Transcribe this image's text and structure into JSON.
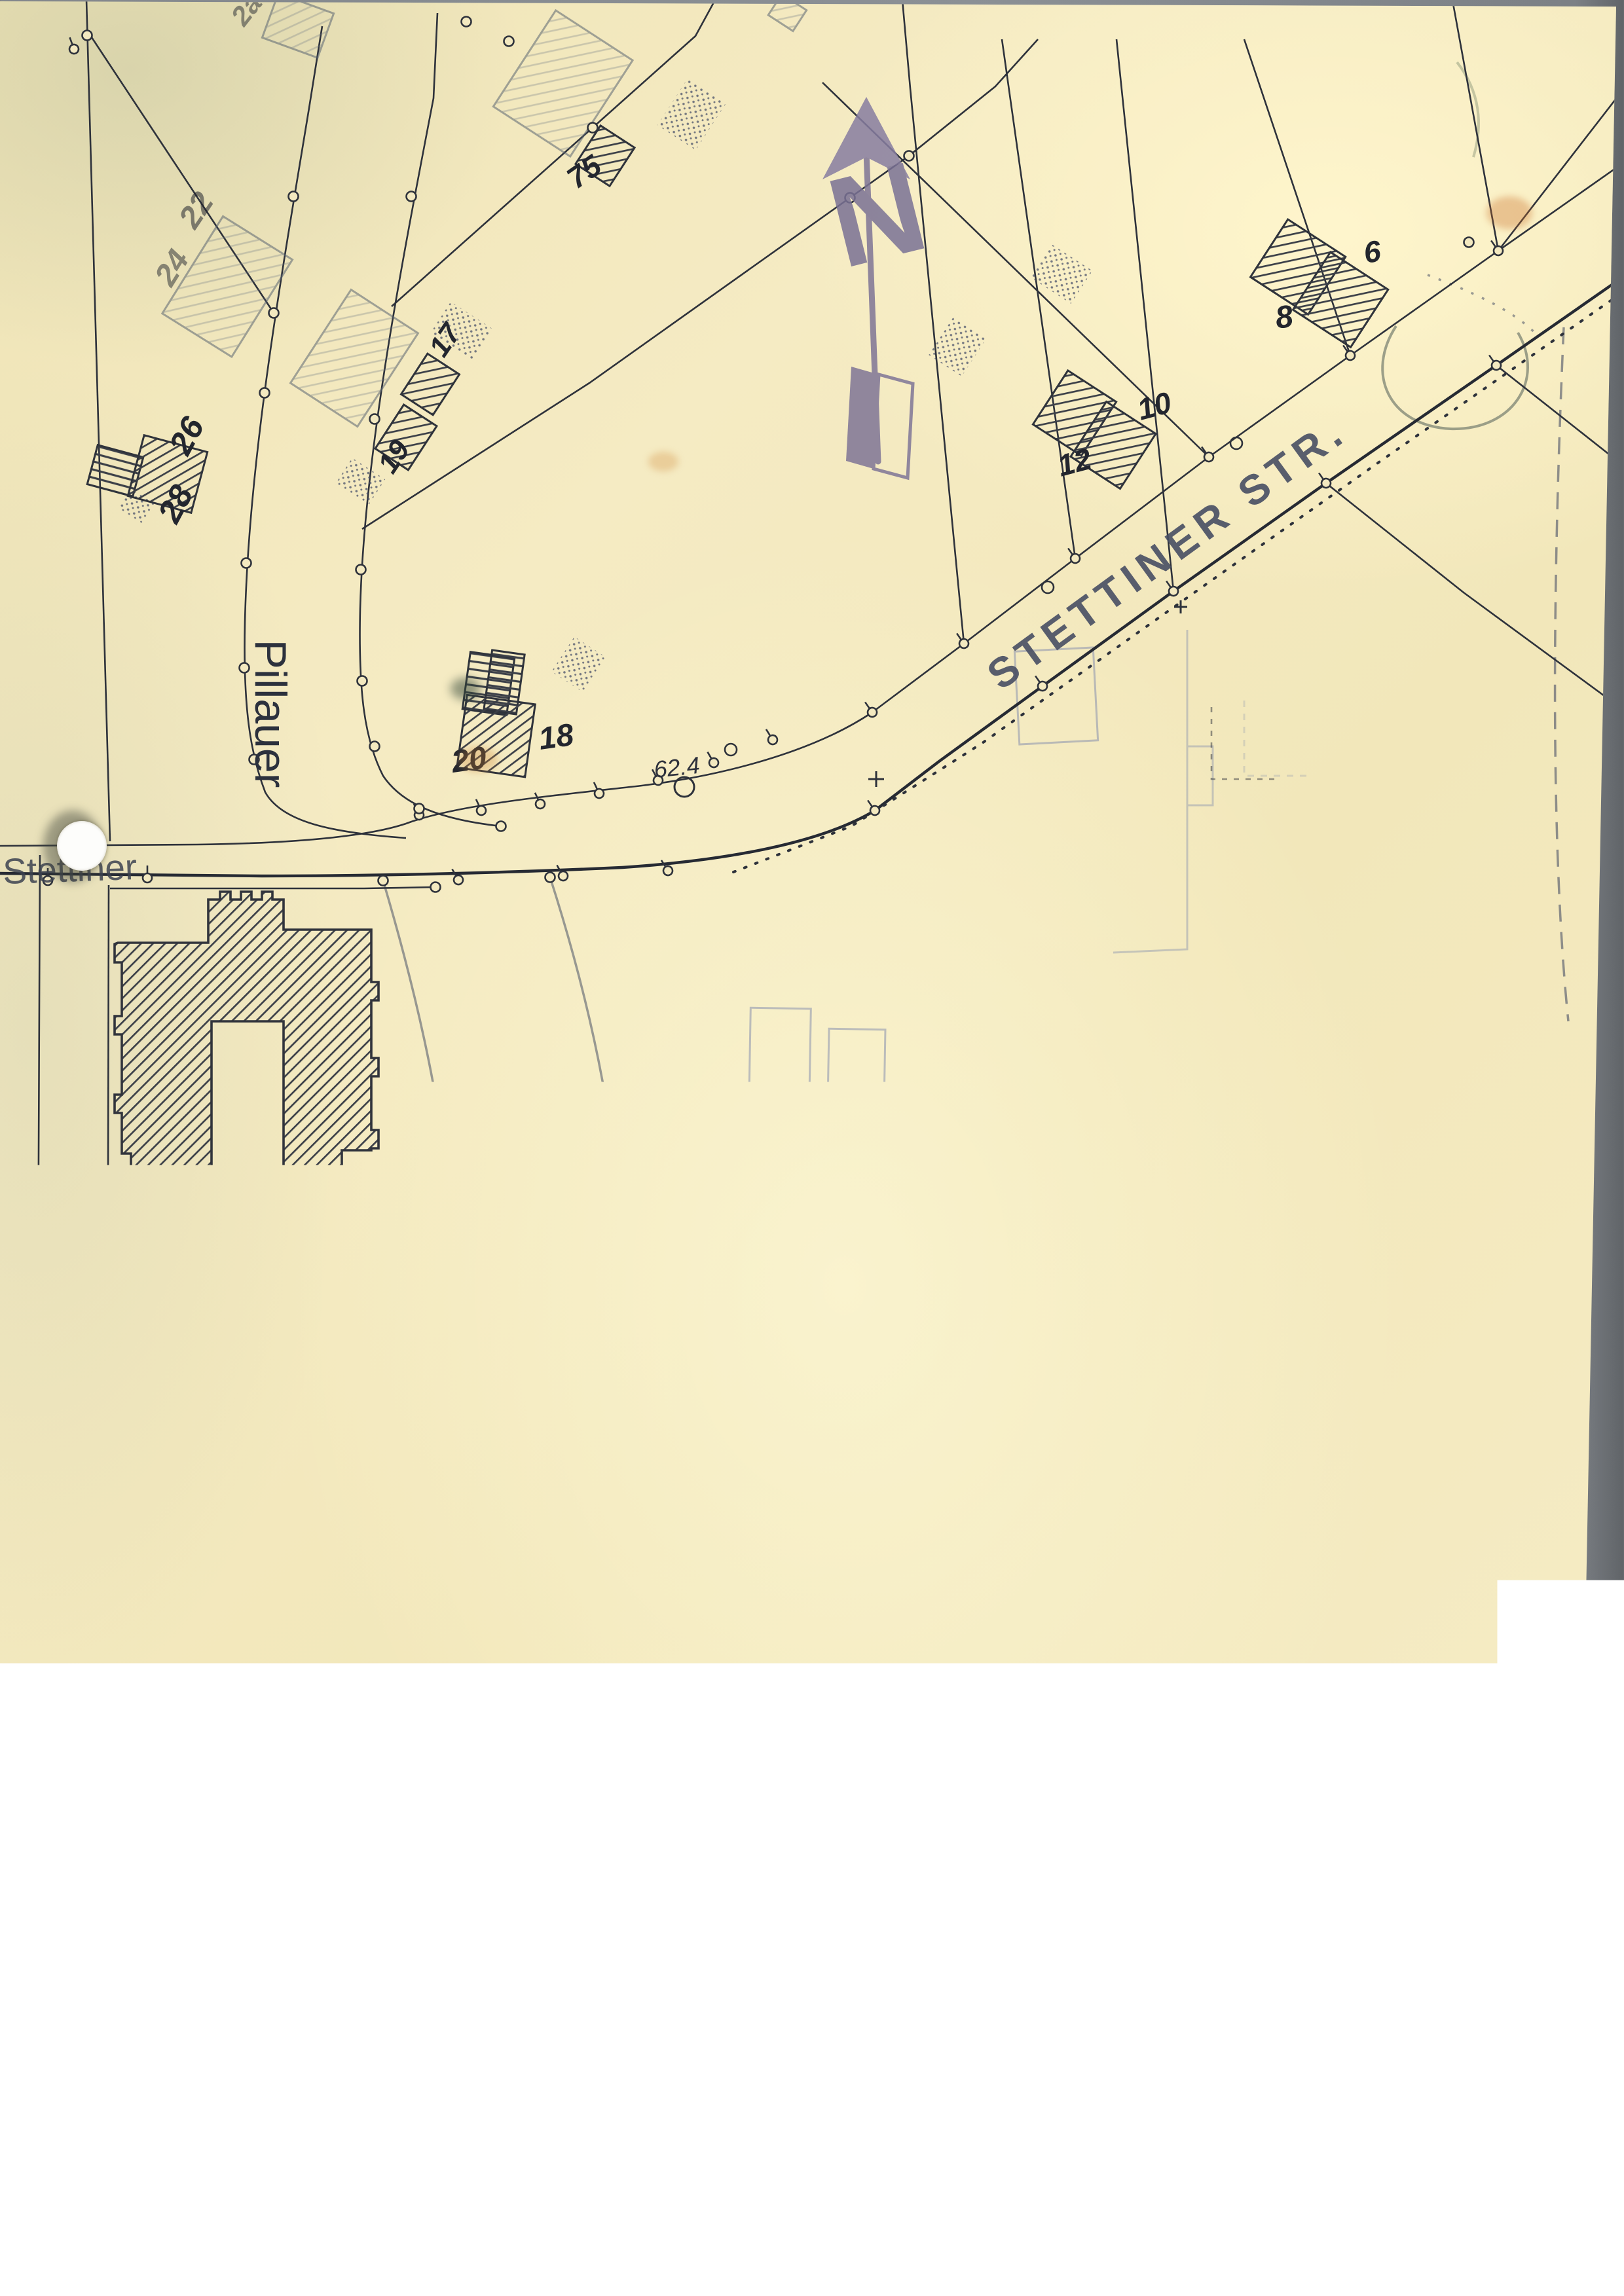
{
  "labels": {
    "north": "N",
    "elevation": "62.4",
    "streets": {
      "stettiner": "STETTINER STR.",
      "stettiner_west": "Stettiner",
      "pillauer": "Pillauer",
      "stichstr": "STICHSTR. NR.4",
      "uhlandstr": "VERL. UHLANDSTR.",
      "cadolzburger": "VERL. CADOLZBURGER STR.",
      "nr41": "Nr.41"
    },
    "house_numbers": {
      "h2a": "2a",
      "h22": "22",
      "h24": "24",
      "h26": "26",
      "h28": "28",
      "h75": "75",
      "h17": "17",
      "h19": "19",
      "h12": "12",
      "h10": "10",
      "h8": "8",
      "h6": "6",
      "h20": "20",
      "h18": "18"
    }
  },
  "title_block": {
    "gez": "Gez.",
    "gepr": "Gepr.",
    "dat": "Dat.",
    "name": "Name",
    "city": "Fürth i.B.",
    "betrieb": "Betrieb",
    "den": "den",
    "date_day_month": "24. 3.",
    "date_year": "1965",
    "fach": "Fach",
    "no": "No.",
    "massstab_label": "Maßstab:",
    "massstab_value": "1 : 1000 .",
    "title": "Bunker Stettiner Str."
  },
  "colors": {
    "paper": "#f3e9c0",
    "ink": "#2a2212",
    "map_line": "#2e323b",
    "faint_blue": "#7e89ac",
    "pencil": "#59606f",
    "north_arrow": "#7e7596"
  }
}
